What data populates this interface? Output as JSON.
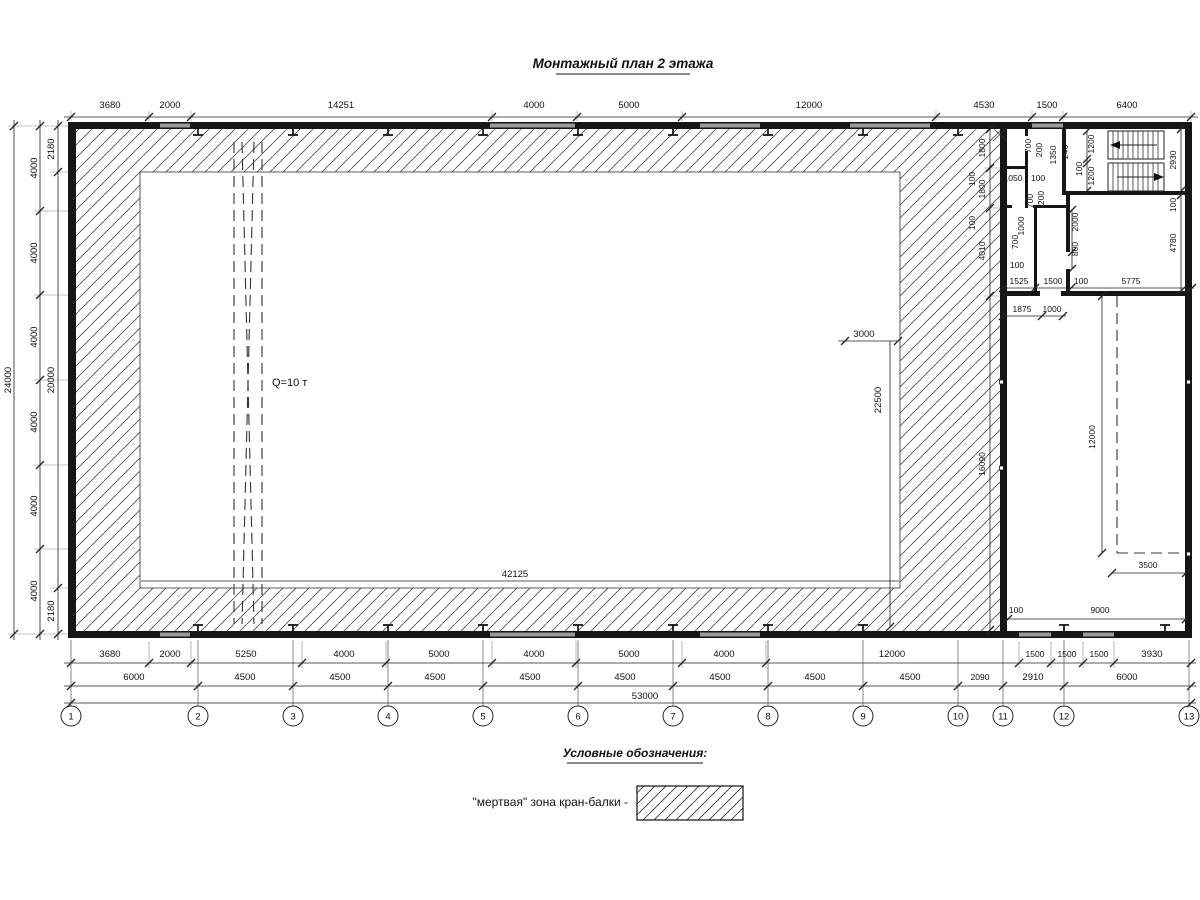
{
  "title": "Монтажный план 2 этажа",
  "legend": {
    "heading": "Условные обозначения:",
    "item": "\"мертвая\" зона кран-балки -"
  },
  "crane": {
    "label": "Q=10 т"
  },
  "axes": [
    "1",
    "2",
    "3",
    "4",
    "5",
    "6",
    "7",
    "8",
    "9",
    "10",
    "11",
    "12",
    "13"
  ],
  "top": [
    "3680",
    "2000",
    "14251",
    "4000",
    "5000",
    "12000",
    "4530",
    "1500",
    "6400"
  ],
  "r1": [
    "3680",
    "2000",
    "5250",
    "4000",
    "5000",
    "4000",
    "5000",
    "4000",
    "12000",
    "1500",
    "1500",
    "1500",
    "3930"
  ],
  "r2": [
    "6000",
    "4500",
    "4500",
    "4500",
    "4500",
    "4500",
    "4500",
    "4500",
    "4500",
    "2090",
    "2910",
    "6000"
  ],
  "total": "53000",
  "left": {
    "outer": "24000",
    "mid": [
      "4000",
      "4000",
      "4000",
      "4000",
      "4000",
      "4000"
    ],
    "inner": [
      "2180",
      "20000",
      "2180"
    ]
  },
  "hall": {
    "inner_width": "42125",
    "dim3000": "3000",
    "dim22500": "22500"
  },
  "rb": {
    "a700": "700",
    "a200": "200",
    "a1350": "1350",
    "a246": "246",
    "fl1": "1200",
    "flg": "100",
    "fl2": "1200",
    "sw": "2930",
    "swg": "100",
    "under": "4780",
    "c1800a": "1800",
    "c100a": "100",
    "c1800b": "1800",
    "c100b": "100",
    "c4010": "4010",
    "c16090": "16090",
    "r1050": "1050",
    "r100": "100",
    "b700": "700",
    "b200": "200",
    "w2000": "2000",
    "w800": "800",
    "d1000": "1000",
    "d700": "700",
    "f100": "100",
    "f1525": "1525",
    "f1500": "1500",
    "f100b": "100",
    "f5775": "5775",
    "g1875": "1875",
    "g1000": "1000",
    "v12000": "12000",
    "h3500": "3500",
    "n100": "100",
    "h9000": "9000"
  }
}
